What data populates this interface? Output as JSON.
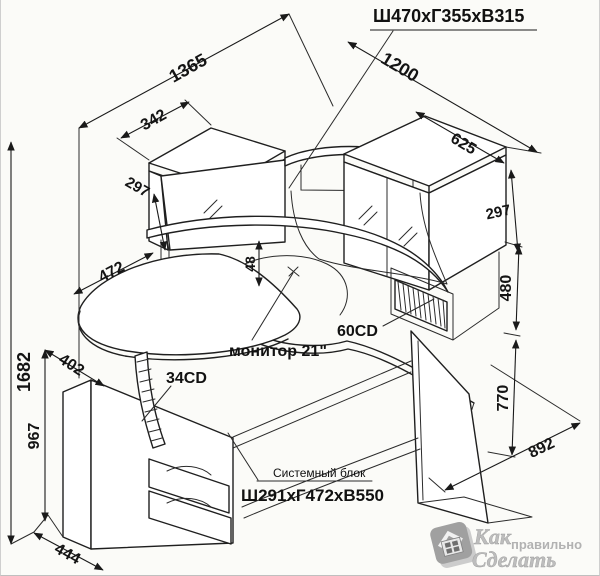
{
  "annotation": {
    "hutch_size_label": "Ш470хГ355хВ315",
    "system_unit_label": "Системный блок",
    "system_unit_size_label": "Ш291хГ472хВ550",
    "monitor_label": "монитор 21\"",
    "cd60_label": "60CD",
    "cd34_label": "34CD"
  },
  "dimensions": {
    "overall_left": "1365",
    "overall_right": "1200",
    "left_cabinet_width": "342",
    "left_cabinet_height": "297",
    "right_cabinet_width": "625",
    "right_cabinet_height": "297",
    "tray_depth": "472",
    "shelf_gap": "48",
    "hutch_height": "480",
    "tray_offset": "402",
    "total_height": "1682",
    "tray_height": "967",
    "desk_height": "770",
    "right_depth": "892",
    "pedestal_width": "444"
  },
  "watermark": {
    "word1": "Как",
    "word2": "правильно",
    "word3": "Сделать"
  },
  "colors": {
    "line": "#1f1f1f",
    "background": "#fbfbf8",
    "watermark": "#b5b5b5"
  }
}
